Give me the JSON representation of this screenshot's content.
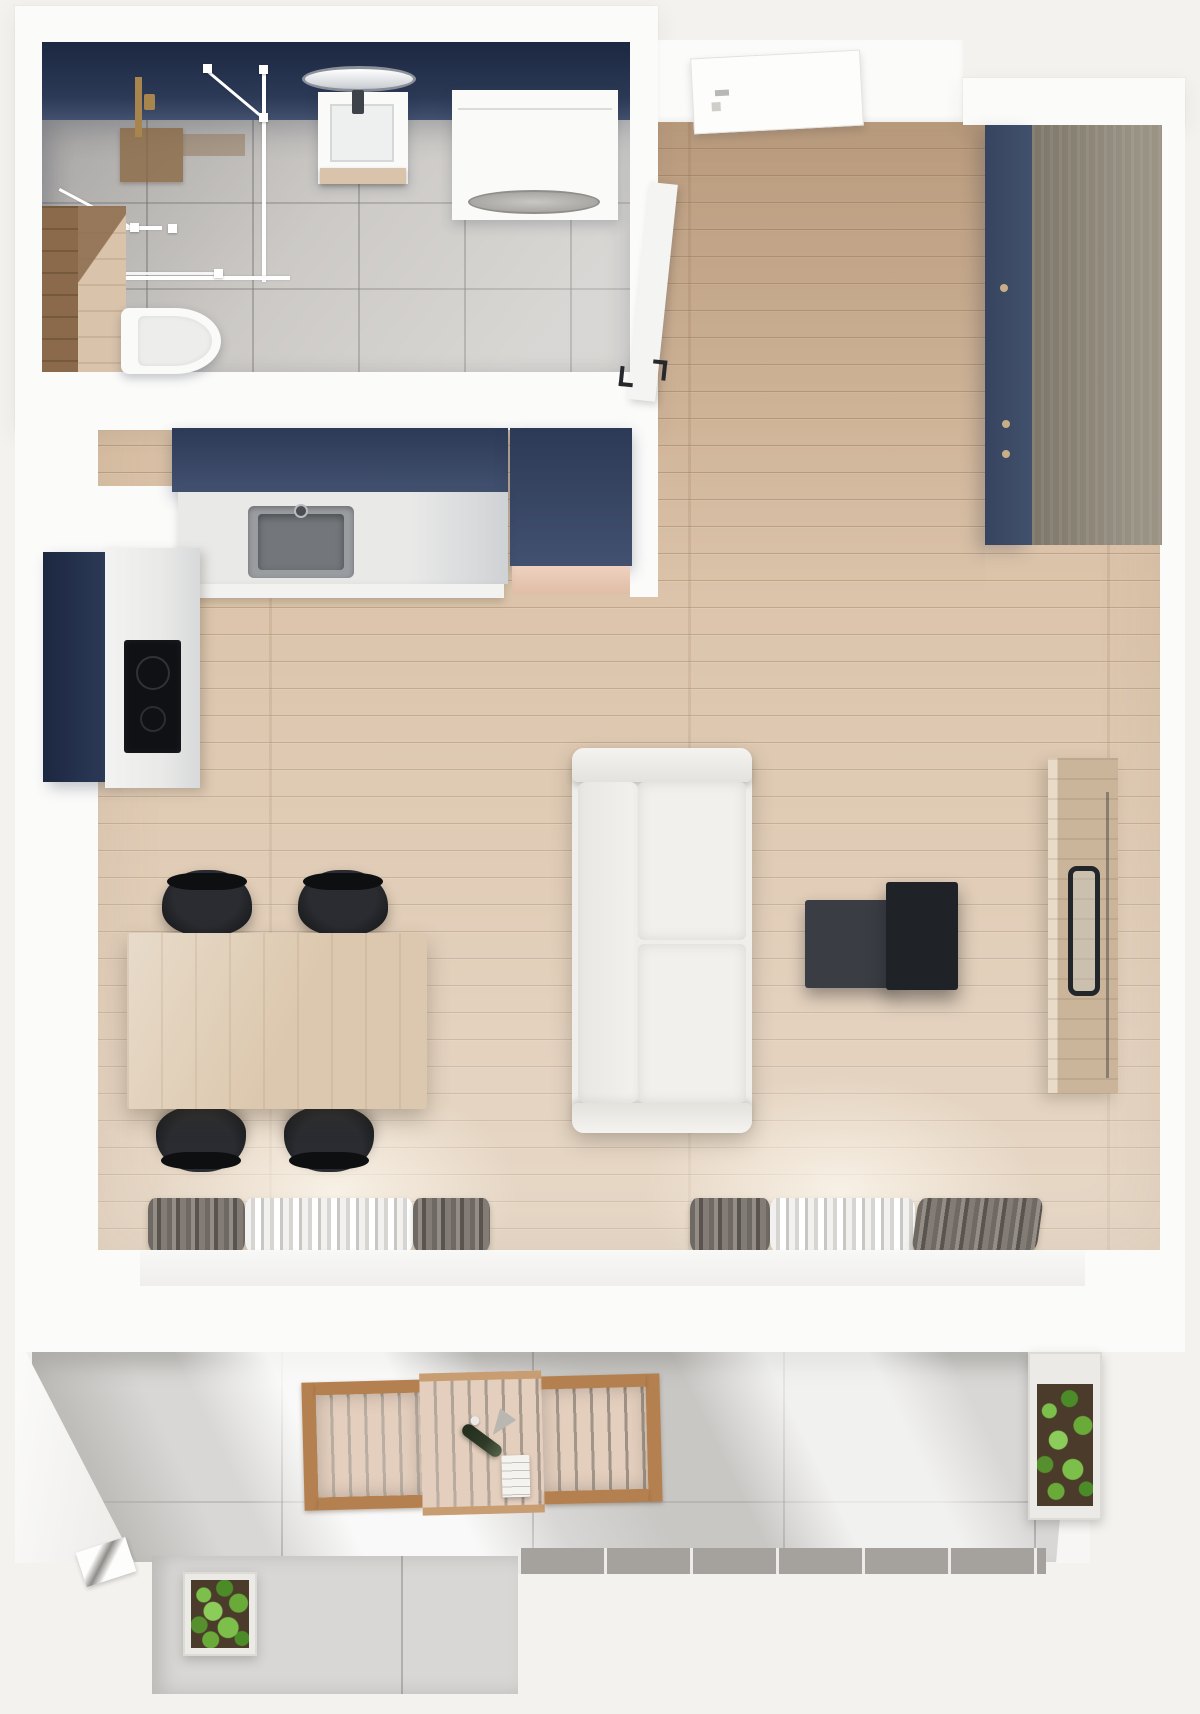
{
  "scene": {
    "type": "apartment-floorplan-top-view-3d-render",
    "rooms": [
      {
        "name": "bathroom",
        "items": [
          "accent-wall",
          "shower-enclosure",
          "shower-mat",
          "shower-fixture",
          "round-mirror",
          "sink-vanity",
          "washing-machine",
          "toilet",
          "wood-bench"
        ]
      },
      {
        "name": "entry-hall",
        "items": [
          "entrance-door",
          "bathroom-door",
          "wardrobe"
        ]
      },
      {
        "name": "kitchen",
        "items": [
          "upper-cabinet-run",
          "tall-cabinet-block",
          "countertop",
          "kitchen-sink",
          "oven-column",
          "cooktop"
        ]
      },
      {
        "name": "living-dining",
        "items": [
          "dining-table",
          "dining-chair",
          "dining-chair",
          "dining-chair",
          "dining-chair",
          "sofa",
          "coffee-table-large",
          "coffee-table-small",
          "tv-sideboard",
          "tv-screen",
          "window-curtains-left",
          "window-curtains-right",
          "window-sill"
        ]
      },
      {
        "name": "balcony",
        "items": [
          "terrace-floor",
          "outdoor-chair-left",
          "outdoor-table",
          "outdoor-chair-right",
          "wine-bottle",
          "serving-tray",
          "planter-left",
          "planter-right",
          "threshold-step"
        ]
      }
    ]
  },
  "palette": {
    "bg": "#f3f2ef",
    "wall": "#fbfbfa",
    "wall_shade": "#e9e7e4",
    "navy_dark": "#1c2740",
    "navy": "#2c3a57",
    "navy_light": "#42516f",
    "bath_tile": "#c8c5c1",
    "bath_tile_light": "#dbd8d5",
    "wood_floor": "#d9c0a5",
    "wood_line": "#8b6a4a",
    "wood_table": "#dcc8ae",
    "bench_side": "#8a6a4b",
    "bench_top": "#d9c3ab",
    "wardrobe_front": "#41506c",
    "wardrobe_top": "#8e8677",
    "brass": "#a9854e",
    "fixture_white": "#fafaf9",
    "drum_gray": "#c2c0bd",
    "counter": "#e9e9e8",
    "sink_gray": "#73777b",
    "cooktop_black": "#0f1114",
    "peach": "#eed2bf",
    "chair_black": "#1d1f22",
    "sofa": "#efeeeb",
    "sofa_line": "#d8d6d1",
    "ctable_dark": "#1f2226",
    "ctable_mid": "#3a3e44",
    "tv_wood": "#cbb59a",
    "tv_dark": "#22262a",
    "curtain_dark": "#6f6963",
    "curtain_mid": "#948d86",
    "curtain_light": "#f2f1ef",
    "sill": "#efeeec",
    "balcony_floor": "#d8d7d5",
    "btile_dark": "#a5a19d",
    "planter": "#eceae7",
    "soil": "#4a3b2a",
    "green1": "#7cbf4a",
    "green2": "#4c8c28",
    "green3": "#69aa39",
    "outdoor_frame": "#b5804f",
    "outdoor_slat": "#e4cebd",
    "outdoor_slat_dark": "#c89d72",
    "bottle_green": "#2f3b28",
    "glass_white": "#ffffff"
  }
}
